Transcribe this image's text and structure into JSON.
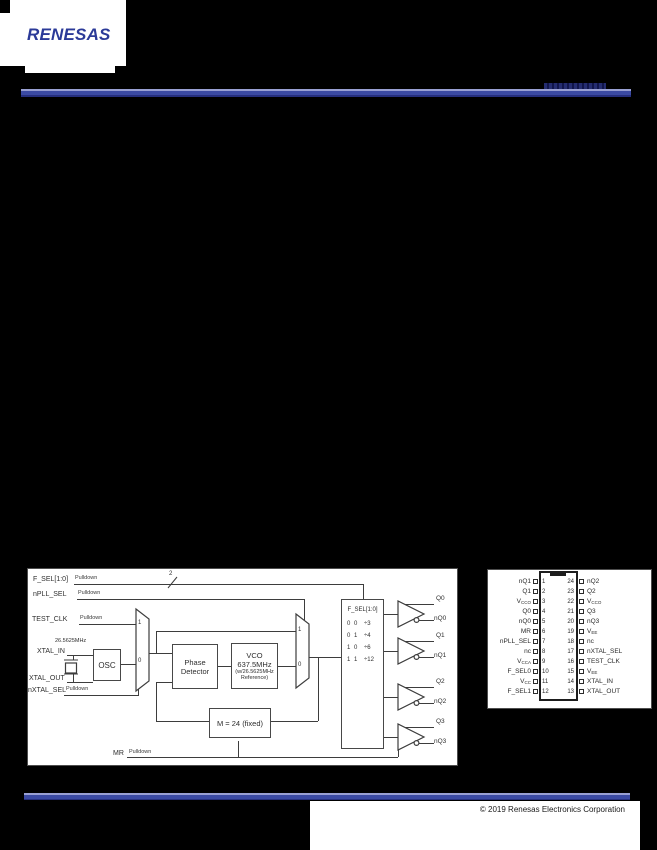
{
  "header": {
    "logo_text": "RENESAS",
    "brand_color": "#2b3a98",
    "bar_color": "#3b4aa3"
  },
  "footer": {
    "copyright": "© 2019 Renesas Electronics Corporation"
  },
  "block_diagram": {
    "inputs": [
      {
        "name": "F_SEL[1:0]",
        "pulldown": "Pulldown",
        "bus_width": "2"
      },
      {
        "name": "nPLL_SEL",
        "pulldown": "Pulldown"
      },
      {
        "name": "TEST_CLK",
        "pulldown": "Pulldown"
      },
      {
        "name": "XTAL_IN"
      },
      {
        "name": "XTAL_OUT"
      },
      {
        "name": "nXTAL_SEL",
        "pulldown": "Pulldown"
      },
      {
        "name": "MR",
        "pulldown": "Pulldown"
      }
    ],
    "crystal_freq": "26.5625MHz",
    "mux_labels": {
      "one": "1",
      "zero": "0"
    },
    "blocks": {
      "osc": "OSC",
      "phase_detector": [
        "Phase",
        "Detector"
      ],
      "vco": [
        "VCO",
        "637.5MHz",
        "(w/26.5625MHz",
        "Reference)"
      ],
      "feedback_divider": "M = 24 (fixed)"
    },
    "divider": {
      "title": "F_SEL[1:0]",
      "rows": [
        {
          "sel": "0 0",
          "div": "÷3"
        },
        {
          "sel": "0 1",
          "div": "÷4"
        },
        {
          "sel": "1 0",
          "div": "÷6"
        },
        {
          "sel": "1 1",
          "div": "÷12"
        }
      ]
    },
    "outputs": [
      {
        "q": "Q0",
        "nq": "nQ0"
      },
      {
        "q": "Q1",
        "nq": "nQ1"
      },
      {
        "q": "Q2",
        "nq": "nQ2"
      },
      {
        "q": "Q3",
        "nq": "nQ3"
      }
    ]
  },
  "pin_diagram": {
    "left_pins": [
      {
        "num": "1",
        "label": "nQ1"
      },
      {
        "num": "2",
        "label": "Q1"
      },
      {
        "num": "3",
        "label": "V",
        "sub": "CCO"
      },
      {
        "num": "4",
        "label": "Q0"
      },
      {
        "num": "5",
        "label": "nQ0"
      },
      {
        "num": "6",
        "label": "MR"
      },
      {
        "num": "7",
        "label": "nPLL_SEL"
      },
      {
        "num": "8",
        "label": "nc"
      },
      {
        "num": "9",
        "label": "V",
        "sub": "CCA"
      },
      {
        "num": "10",
        "label": "F_SEL0"
      },
      {
        "num": "11",
        "label": "V",
        "sub": "CC"
      },
      {
        "num": "12",
        "label": "F_SEL1"
      }
    ],
    "right_pins": [
      {
        "num": "24",
        "label": "nQ2"
      },
      {
        "num": "23",
        "label": "Q2"
      },
      {
        "num": "22",
        "label": "V",
        "sub": "CCO"
      },
      {
        "num": "21",
        "label": "Q3"
      },
      {
        "num": "20",
        "label": "nQ3"
      },
      {
        "num": "19",
        "label": "V",
        "sub": "EE"
      },
      {
        "num": "18",
        "label": "nc"
      },
      {
        "num": "17",
        "label": "nXTAL_SEL"
      },
      {
        "num": "16",
        "label": "TEST_CLK"
      },
      {
        "num": "15",
        "label": "V",
        "sub": "EE"
      },
      {
        "num": "14",
        "label": "XTAL_IN"
      },
      {
        "num": "13",
        "label": "XTAL_OUT"
      }
    ]
  }
}
